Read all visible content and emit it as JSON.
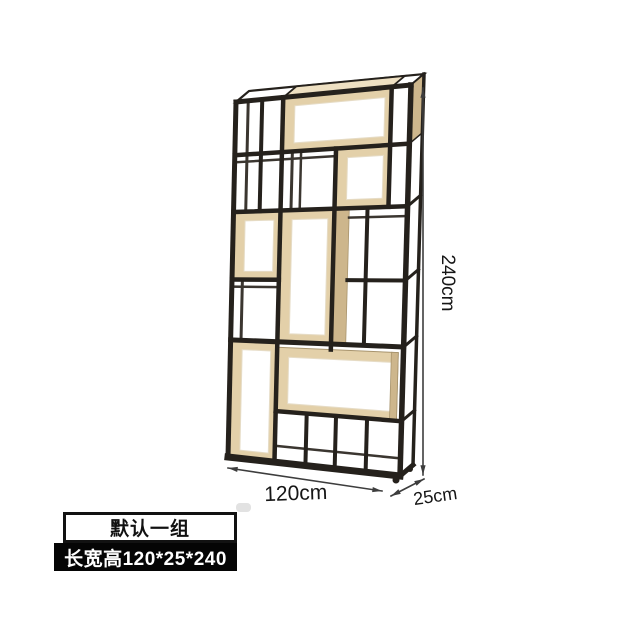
{
  "dimensions": {
    "height": "240cm",
    "width": "120cm",
    "depth": "25cm"
  },
  "badges": {
    "variant": "默认一组",
    "spec": "长宽高120*25*240"
  },
  "colors": {
    "frame": "#25211c",
    "frame_back": "#3b3630",
    "wood": "#e3d0a9",
    "wood_dark": "#cdb68c",
    "wood_light": "#eee0c2",
    "wood_edge": "#a8946d",
    "inner_edge": "#e6dcc6",
    "dim": "#3d3d3d",
    "text": "#161616",
    "background": "#ffffff"
  },
  "shelf": {
    "face": {
      "tl": [
        236,
        102
      ],
      "tr": [
        411,
        85
      ],
      "br": [
        400,
        476
      ],
      "bl": [
        228,
        457
      ]
    },
    "depth": [
      13,
      -11
    ],
    "members": [
      {
        "a": [
          0,
          0
        ],
        "b": [
          0,
          1
        ],
        "w": 5
      },
      {
        "a": [
          0.27,
          0
        ],
        "b": [
          0.27,
          1
        ],
        "w": 4.5
      },
      {
        "a": [
          0.58,
          0.15
        ],
        "b": [
          0.58,
          0.685
        ],
        "w": 4.5
      },
      {
        "a": [
          0.89,
          0
        ],
        "b": [
          0.89,
          0.31
        ],
        "w": 4.5
      },
      {
        "a": [
          0.77,
          0.31
        ],
        "b": [
          0.77,
          0.67
        ],
        "w": 4
      },
      {
        "a": [
          0.15,
          0
        ],
        "b": [
          0.15,
          0.31
        ],
        "w": 4
      },
      {
        "a": [
          1,
          0
        ],
        "b": [
          1,
          1
        ],
        "w": 5.5
      },
      {
        "a": [
          0.45,
          0.86
        ],
        "b": [
          0.45,
          1
        ],
        "w": 4
      },
      {
        "a": [
          0.62,
          0.86
        ],
        "b": [
          0.62,
          1
        ],
        "w": 4
      },
      {
        "a": [
          0.8,
          0.86
        ],
        "b": [
          0.8,
          1
        ],
        "w": 4
      },
      {
        "a": [
          0,
          0
        ],
        "b": [
          1,
          0
        ],
        "w": 5
      },
      {
        "a": [
          0,
          0.15
        ],
        "b": [
          1,
          0.15
        ],
        "w": 4.5
      },
      {
        "a": [
          0,
          0.31
        ],
        "b": [
          1,
          0.31
        ],
        "w": 4.5
      },
      {
        "a": [
          0,
          0.5
        ],
        "b": [
          0.27,
          0.5
        ],
        "w": 4.5
      },
      {
        "a": [
          0.665,
          0.5
        ],
        "b": [
          1,
          0.5
        ],
        "w": 4
      },
      {
        "a": [
          0,
          0.67
        ],
        "b": [
          1,
          0.67
        ],
        "w": 5
      },
      {
        "a": [
          0.27,
          0.86
        ],
        "b": [
          1,
          0.86
        ],
        "w": 4.5
      },
      {
        "a": [
          0,
          1
        ],
        "b": [
          1,
          1
        ],
        "w": 7
      },
      {
        "a": [
          0.07,
          0
        ],
        "b": [
          0.07,
          0.31
        ],
        "w": 3,
        "k": "b"
      },
      {
        "a": [
          0.33,
          0.15
        ],
        "b": [
          0.33,
          0.31
        ],
        "w": 3,
        "k": "b"
      },
      {
        "a": [
          0.38,
          0.15
        ],
        "b": [
          0.38,
          0.31
        ],
        "w": 2.5,
        "k": "b"
      },
      {
        "a": [
          0.06,
          0.5
        ],
        "b": [
          0.06,
          0.67
        ],
        "w": 3,
        "k": "b"
      },
      {
        "a": [
          0,
          0.17
        ],
        "b": [
          0.58,
          0.17
        ],
        "w": 2.5,
        "k": "b"
      },
      {
        "a": [
          0.665,
          0.335
        ],
        "b": [
          1,
          0.335
        ],
        "w": 2.5,
        "k": "b"
      },
      {
        "a": [
          0,
          0.52
        ],
        "b": [
          0.27,
          0.52
        ],
        "w": 2.5,
        "k": "b"
      },
      {
        "a": [
          0.27,
          0.955
        ],
        "b": [
          1,
          0.955
        ],
        "w": 2.5,
        "k": "b"
      }
    ],
    "boxes": [
      {
        "u1": 0.27,
        "v1": 0,
        "u2": 0.89,
        "v2": 0.15
      },
      {
        "u1": 0.58,
        "v1": 0.15,
        "u2": 0.89,
        "v2": 0.31
      },
      {
        "u1": 0,
        "v1": 0.31,
        "u2": 0.27,
        "v2": 0.5
      },
      {
        "u1": 0.27,
        "v1": 0.31,
        "u2": 0.58,
        "v2": 0.67
      },
      {
        "u1": 0,
        "v1": 0.67,
        "u2": 0.27,
        "v2": 1
      },
      {
        "u1": 0.27,
        "v1": 0.685,
        "u2": 0.97,
        "v2": 0.86
      }
    ],
    "side_panels": [
      {
        "u1": 0.575,
        "v1": 0.31,
        "u2": 0.665,
        "v2": 0.67
      },
      {
        "u1": 0.93,
        "v1": 0.685,
        "u2": 0.97,
        "v2": 0.86
      }
    ],
    "right_face_slats": [
      0.31,
      0.5,
      0.67,
      0.86
    ],
    "wood_top_span": [
      0.27,
      0.89
    ],
    "wood_side_span_v": 0.15
  },
  "annotations": {
    "height_arrow": {
      "x": 423,
      "y1": 88,
      "y2": 475
    },
    "width_arrow": {
      "a": [
        228,
        468
      ],
      "b": [
        382,
        491
      ]
    },
    "depth_arrow": {
      "a": [
        391,
        496
      ],
      "b": [
        424,
        479
      ]
    },
    "height_label": {
      "x": 442,
      "y": 283,
      "rot": 90,
      "size": 19
    },
    "width_label": {
      "x": 296,
      "y": 500,
      "rot": -2,
      "size": 21
    },
    "depth_label": {
      "x": 436,
      "y": 502,
      "rot": -8,
      "size": 18
    }
  }
}
